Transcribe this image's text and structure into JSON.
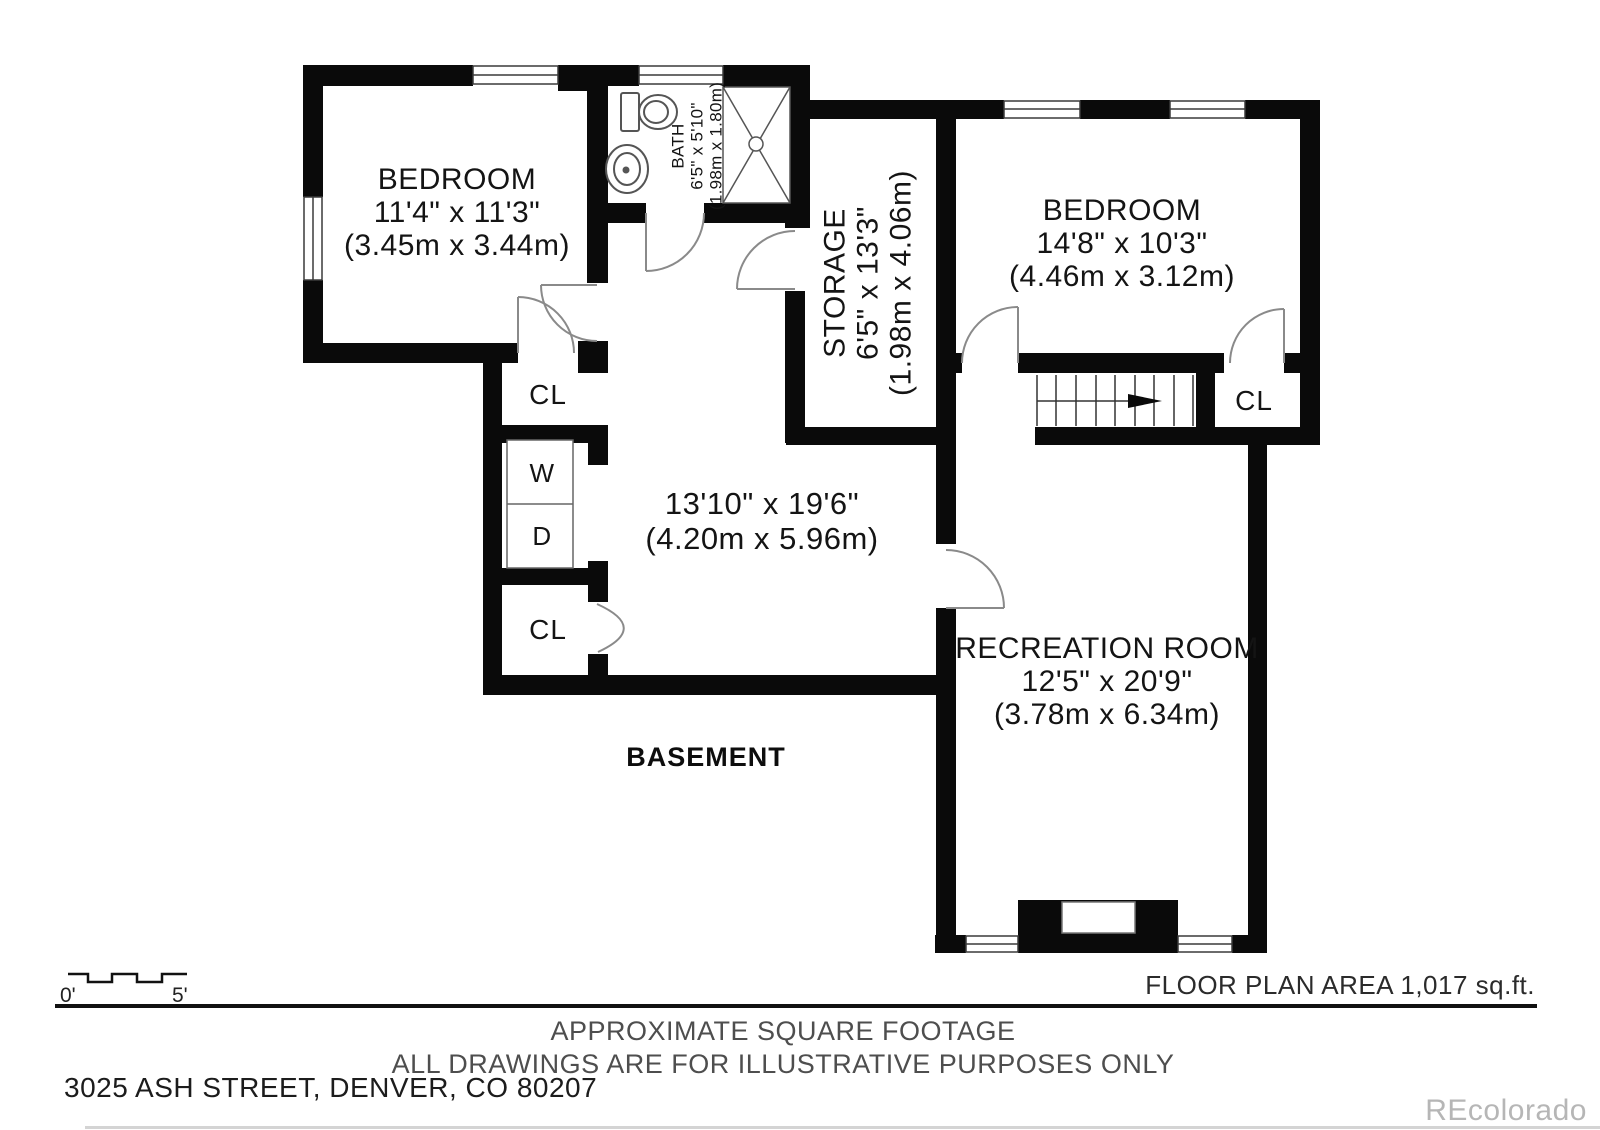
{
  "plan": {
    "floor_label": "BASEMENT",
    "rooms": {
      "bedroom_left": {
        "name": "BEDROOM",
        "imperial": "11'4\" x 11'3\"",
        "metric": "(3.45m x 3.44m)"
      },
      "bath": {
        "name": "BATH",
        "imperial": "6'5\" x 5'10\"",
        "metric": "(1.98m x 1.80m)"
      },
      "storage": {
        "name": "STORAGE",
        "imperial": "6'5\" x 13'3\"",
        "metric": "(1.98m x 4.06m)"
      },
      "bedroom_right": {
        "name": "BEDROOM",
        "imperial": "14'8\" x 10'3\"",
        "metric": "(4.46m x 3.12m)"
      },
      "center_room": {
        "imperial": "13'10\" x 19'6\"",
        "metric": "(4.20m x 5.96m)"
      },
      "recreation": {
        "name": "RECREATION ROOM",
        "imperial": "12'5\" x 20'9\"",
        "metric": "(3.78m x 6.34m)"
      }
    },
    "labels": {
      "closet": "CL",
      "washer": "W",
      "dryer": "D"
    }
  },
  "scale_bar": {
    "start": "0'",
    "end": "5'"
  },
  "footer": {
    "area_note": "FLOOR PLAN AREA 1,017 sq.ft.",
    "disclaimer_line1": "APPROXIMATE SQUARE FOOTAGE",
    "disclaimer_line2": "ALL DRAWINGS ARE FOR ILLUSTRATIVE PURPOSES ONLY",
    "address": "3025 ASH STREET, DENVER, CO 80207",
    "watermark": "REcolorado"
  },
  "colors": {
    "wall": "#0a0a0a",
    "door_arc": "#8a8a8a",
    "fixture_line": "#555555",
    "watermark_gray": "#b6b6b6"
  }
}
